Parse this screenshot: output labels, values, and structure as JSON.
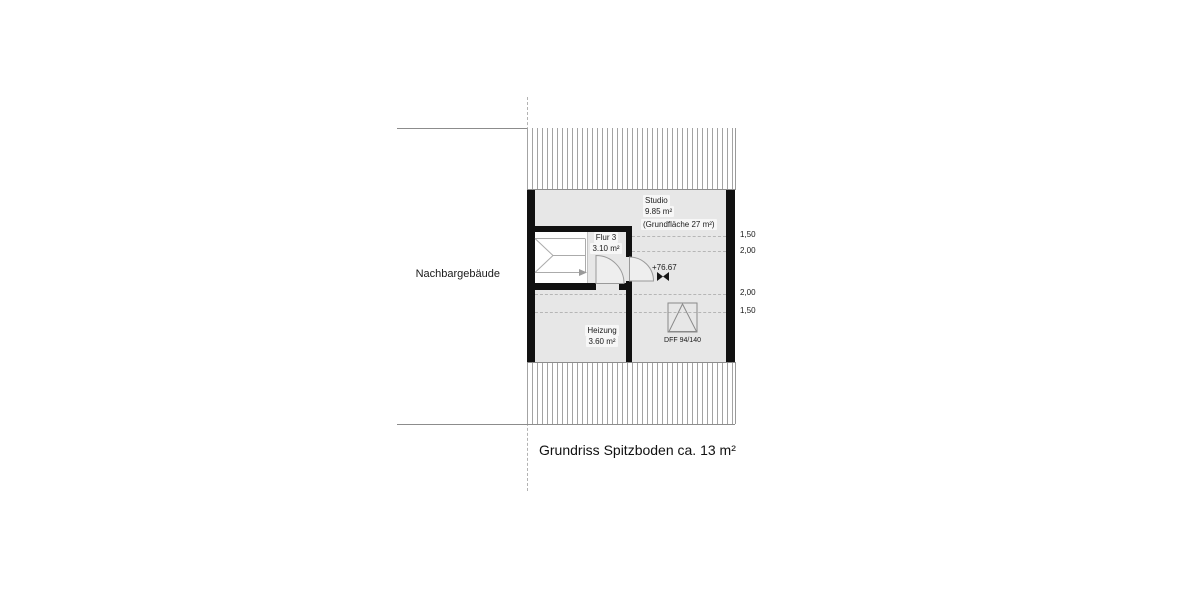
{
  "title": "Grundriss Spitzboden ca. 13 m²",
  "neighbor_label": "Nachbargebäude",
  "rooms": {
    "studio": {
      "name": "Studio",
      "area": "9.85 m²",
      "note": "(Grundfläche 27 m²)"
    },
    "flur": {
      "name": "Flur 3",
      "area": "3.10 m²"
    },
    "heizung": {
      "name": "Heizung",
      "area": "3.60 m²"
    }
  },
  "annotations": {
    "level": "+76.67",
    "roof_window": "DFF 94/140"
  },
  "dimensions": [
    {
      "text": "1,50"
    },
    {
      "text": "2,00"
    },
    {
      "text": "2,00"
    },
    {
      "text": "1,50"
    }
  ],
  "icons": {
    "level_marker": "level-marker",
    "roof_window": "roof-window-symbol",
    "stair_direction": "stair-direction-arrow"
  },
  "colors": {
    "wall": "#111111",
    "floor": "#e7e7e7",
    "hatch_line": "#a3a3a3",
    "dash_line": "#b3b3b3",
    "text": "#1a1a1a"
  }
}
